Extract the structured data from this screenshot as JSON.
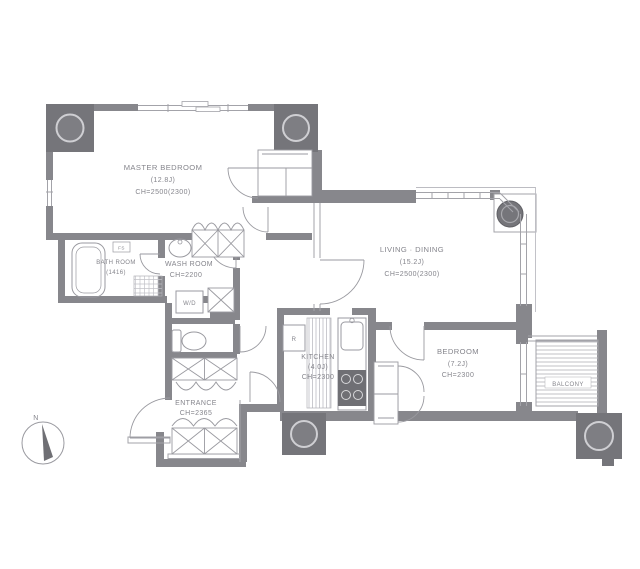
{
  "plan_title": "Apartment floor plan",
  "rooms": {
    "master_bedroom": {
      "name": "MASTER BEDROOM",
      "size": "(12.8J)",
      "ceiling": "CH=2500(2300)"
    },
    "living_dining": {
      "name": "LIVING · DINING",
      "size": "(15.2J)",
      "ceiling": "CH=2500(2300)"
    },
    "bath_room": {
      "name": "BATH ROOM",
      "size": "(1416)"
    },
    "wash_room": {
      "name": "WASH ROOM",
      "ceiling": "CH=2200"
    },
    "entrance": {
      "name": "ENTRANCE",
      "ceiling": "CH=2365"
    },
    "kitchen": {
      "name": "KITCHEN",
      "size": "(4.0J)",
      "ceiling": "CH=2300"
    },
    "bedroom": {
      "name": "BEDROOM",
      "size": "(7.2J)",
      "ceiling": "CH=2300"
    },
    "balcony": {
      "name": "BALCONY"
    }
  },
  "fixtures": {
    "washer_dryer": "W/D",
    "refrigerator": "R",
    "fan_switch": "FS"
  },
  "compass": {
    "north": "N"
  },
  "colors": {
    "wall": "#87878c",
    "column": "#75757a",
    "thin_line": "#a3a3a9",
    "hatch": "#c0c0c6",
    "text": "#85858c",
    "background": "#ffffff"
  }
}
